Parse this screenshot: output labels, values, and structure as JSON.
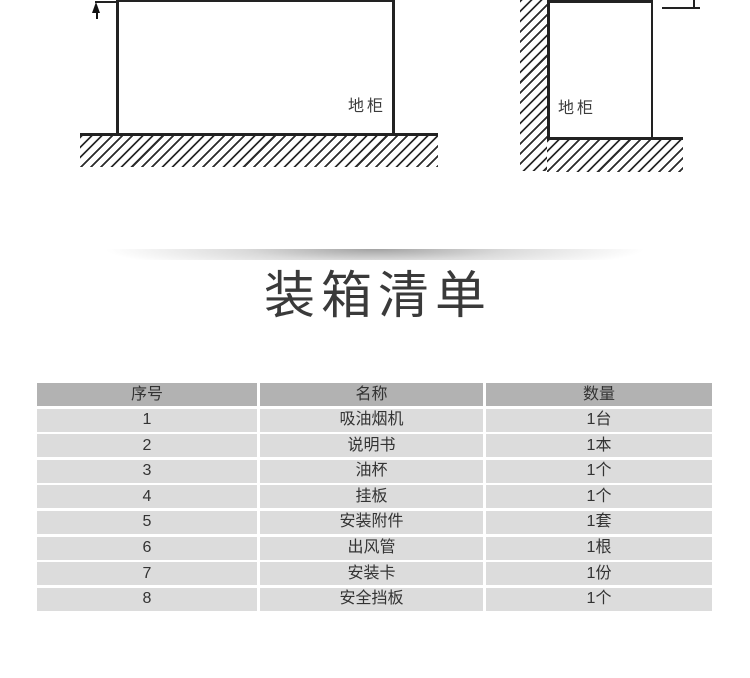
{
  "diagrams": {
    "left": {
      "cabinet_label": "地柜"
    },
    "right": {
      "cabinet_label": "地柜"
    }
  },
  "section": {
    "title": "装箱清单"
  },
  "packing_table": {
    "columns": [
      "序号",
      "名称",
      "数量"
    ],
    "rows": [
      [
        "1",
        "吸油烟机",
        "1台"
      ],
      [
        "2",
        "说明书",
        "1本"
      ],
      [
        "3",
        "油杯",
        "1个"
      ],
      [
        "4",
        "挂板",
        "1个"
      ],
      [
        "5",
        "安装附件",
        "1套"
      ],
      [
        "6",
        "出风管",
        "1根"
      ],
      [
        "7",
        "安装卡",
        "1份"
      ],
      [
        "8",
        "安全挡板",
        "1个"
      ]
    ],
    "colors": {
      "header_bg": "#b2b2b2",
      "row_bg": "#dcdcdc",
      "text": "#333333"
    }
  }
}
